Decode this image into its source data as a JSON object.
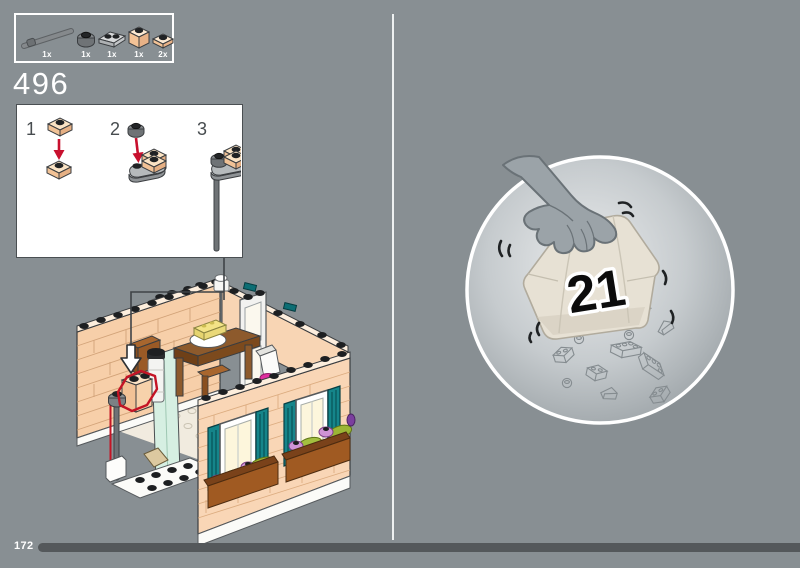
{
  "page": {
    "step_number": "496",
    "page_number": "172",
    "background_color": "#888f93",
    "progress_bar_color": "#54585b",
    "divider_color": "#eef1f1"
  },
  "parts_panel": {
    "items": [
      {
        "icon": "bar-6l-gray",
        "count": "1x"
      },
      {
        "icon": "round-plate-1x1-dark-gray",
        "count": "1x"
      },
      {
        "icon": "plate-1x2-rounded-gray",
        "count": "1x"
      },
      {
        "icon": "brick-1x1-nougat",
        "count": "1x"
      },
      {
        "icon": "plate-1x1-nougat",
        "count": "2x"
      }
    ]
  },
  "steps_panel": {
    "steps": [
      {
        "number": "1"
      },
      {
        "number": "2"
      },
      {
        "number": "3"
      }
    ],
    "arrow_color": "#c8102e"
  },
  "model_callout": {
    "highlight_color": "#c41425",
    "wall_color": "#f7cfa9",
    "shutter_color": "#15858a",
    "flower_box_color": "#a05a22",
    "accent_magenta": "#df2f9f"
  },
  "bag_callout": {
    "bag_number": "21",
    "bag_color": "#e7e1d4",
    "hand_color": "#9ba3a8"
  }
}
